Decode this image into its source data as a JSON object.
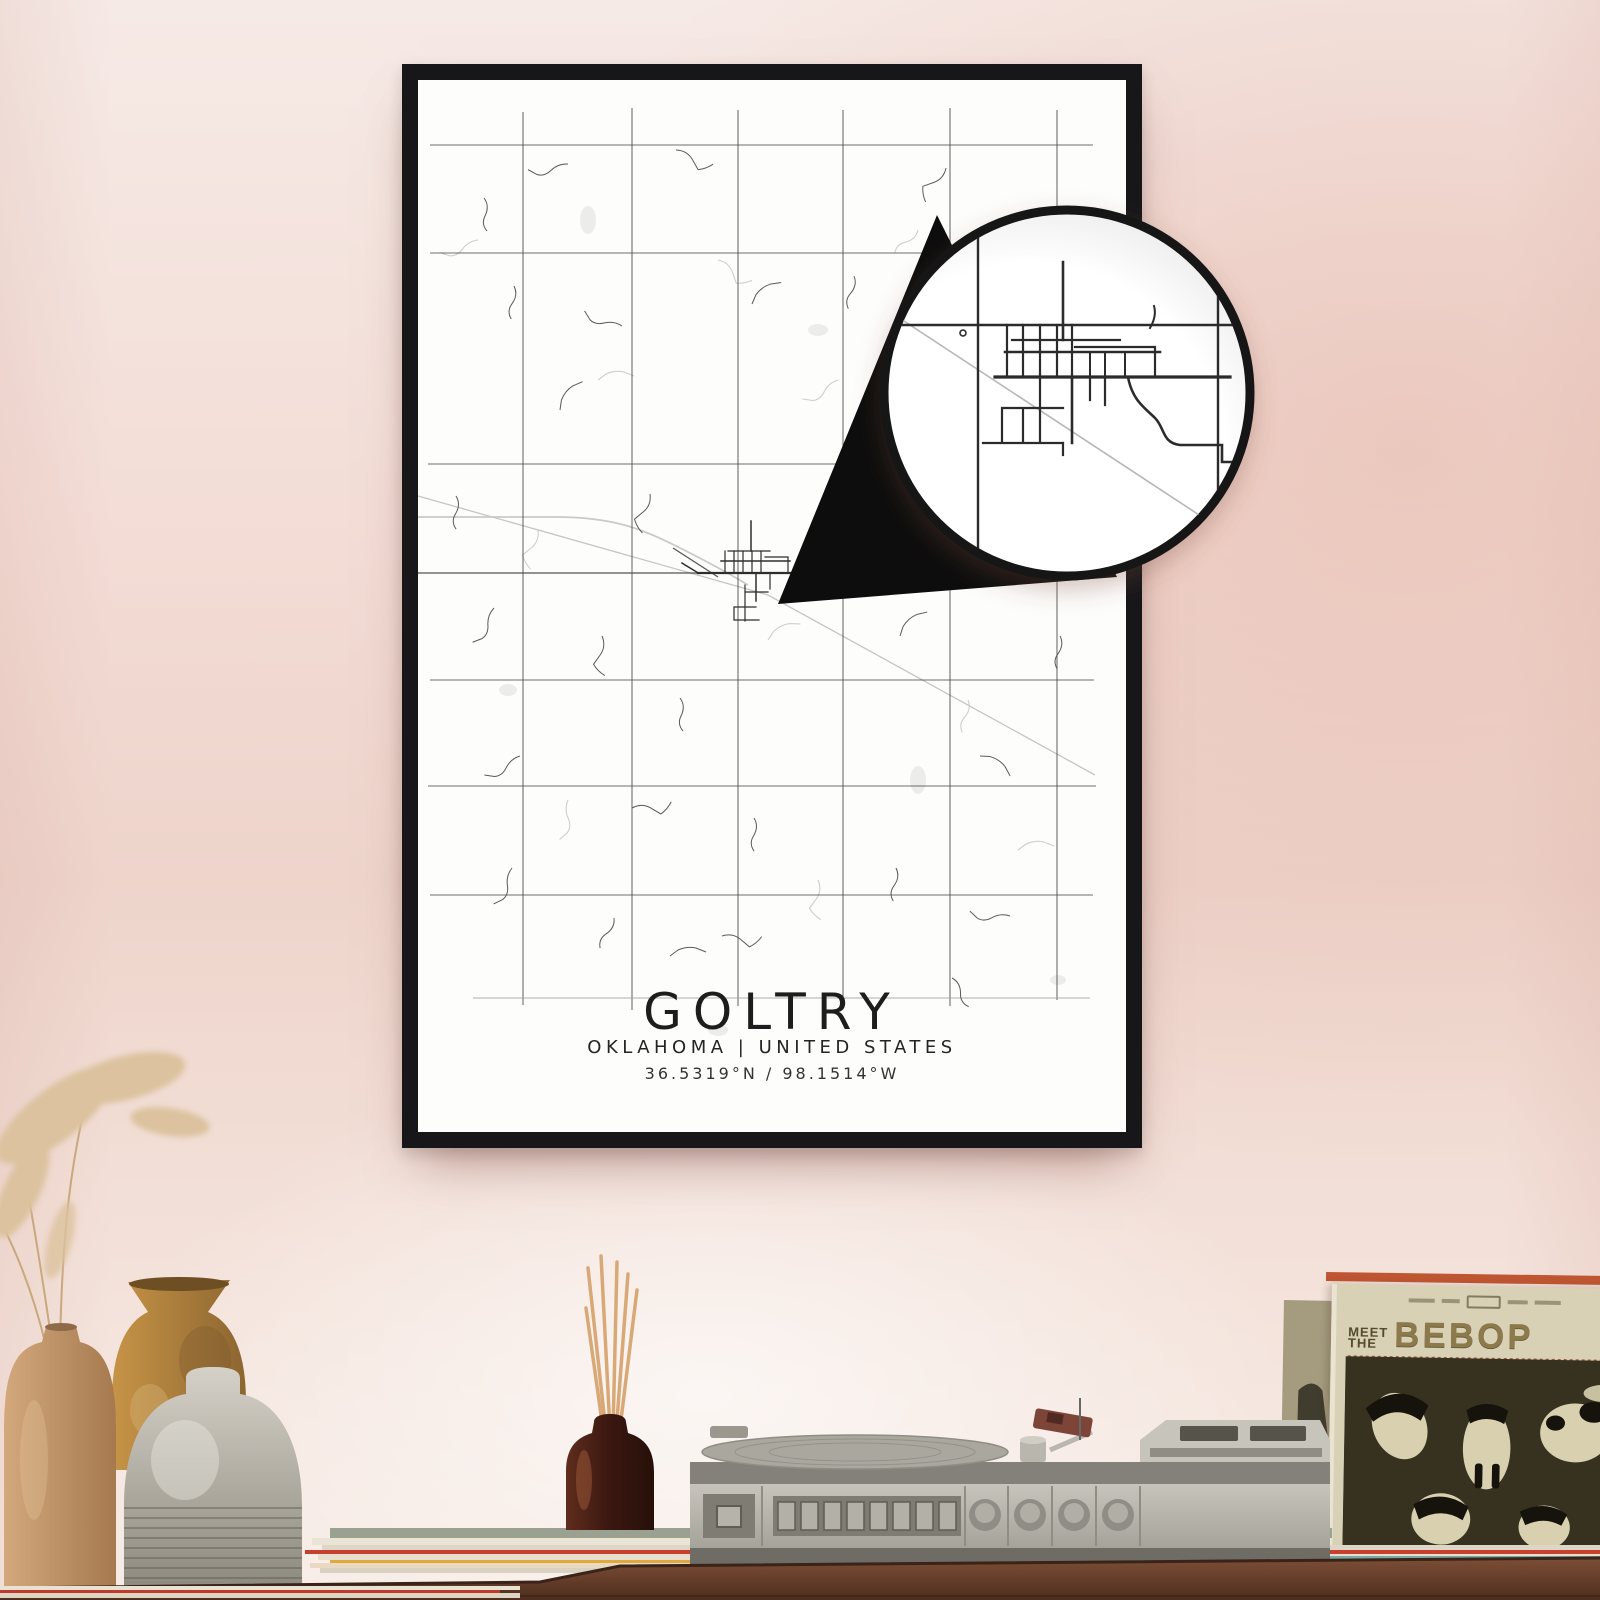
{
  "poster": {
    "title": "GOLTRY",
    "subtitle": "OKLAHOMA | UNITED STATES",
    "coordinates": "36.5319°N / 98.1514°W"
  },
  "record_sleeve": {
    "pretitle_top": "MEET",
    "pretitle_bottom": "THE",
    "title": "BEBOP"
  },
  "colors": {
    "wall_pink": "#f2d9d2",
    "frame_black": "#17171a",
    "paper_white": "#fdfdfc",
    "road_dark": "#454545",
    "road_light": "#c5c5c5",
    "table_wood": "#6f4733",
    "sleeve_cream": "#d8d1b6",
    "sleeve_title_olive": "#8c7a4c",
    "turntable_gray": "#bdbbb2",
    "diffuser_brown": "#4a2317",
    "vase_tan": "#c49a6e",
    "vase_mustard": "#b98a40",
    "vase_gray": "#b5b1a7"
  }
}
